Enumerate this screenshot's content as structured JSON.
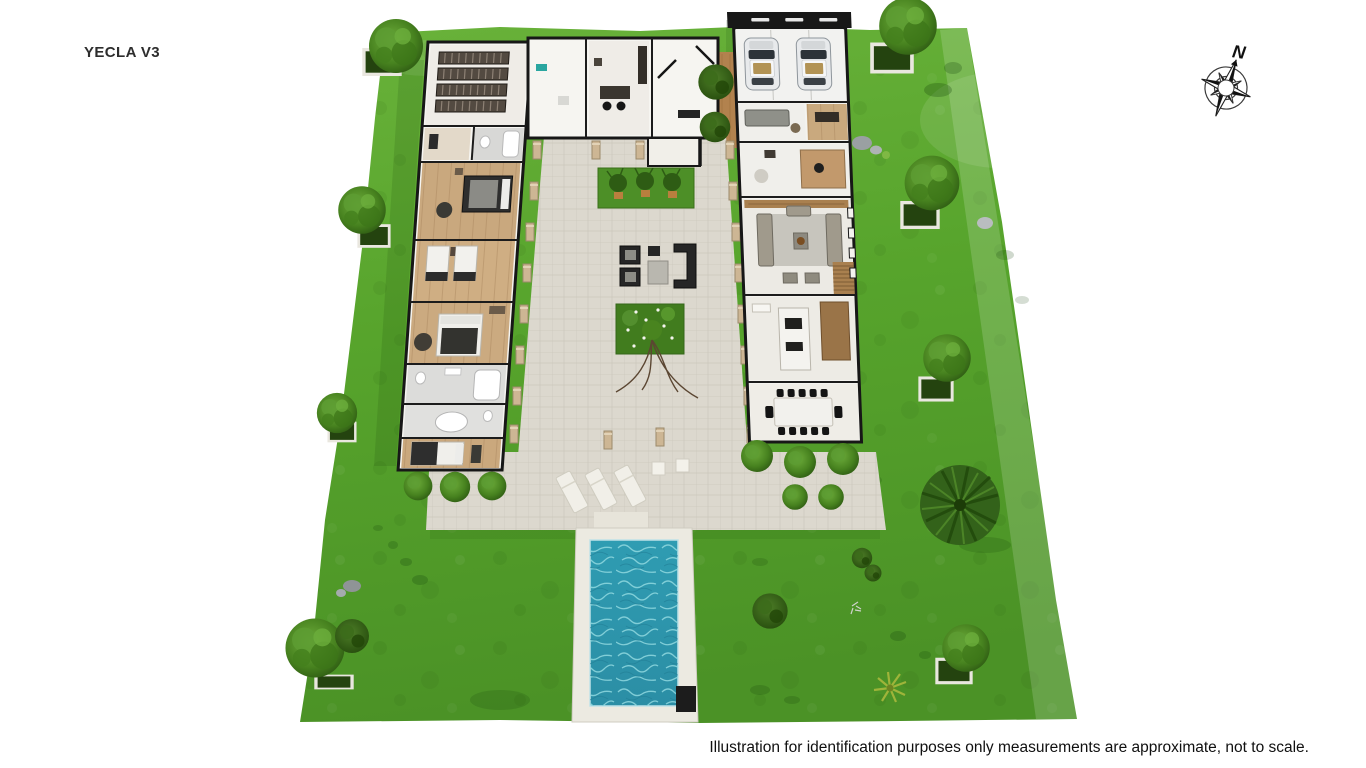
{
  "page": {
    "title": "YECLA V3",
    "disclaimer": "Illustration for identification purposes only measurements are approximate, not to scale."
  },
  "compass": {
    "label": "N"
  },
  "illustration": {
    "type": "3d-site-plan",
    "icons": [
      "compass-rose-icon",
      "tree-icon",
      "palm-tree-icon",
      "car-icon",
      "pool-icon",
      "sun-lounger-icon",
      "pergola-column-icon",
      "planter-box-icon"
    ],
    "areas": [
      "lawn",
      "central-courtyard",
      "swimming-pool",
      "left-bedroom-wing",
      "entry-block",
      "garage",
      "living-kitchen-dining-wing"
    ],
    "colors": {
      "lawn_green": "#57a42c",
      "dark_foliage": "#2f5d13",
      "terrace_paver": "#dcd8ce",
      "pool_water": "#2f98ad",
      "pool_deck": "#eceae1",
      "wall_dark": "#171717",
      "building_white": "#f6f5f1",
      "wood_floor": "#c9a87e",
      "dirt_brown": "#b2824e",
      "pillar_tan": "#cdb694"
    }
  }
}
